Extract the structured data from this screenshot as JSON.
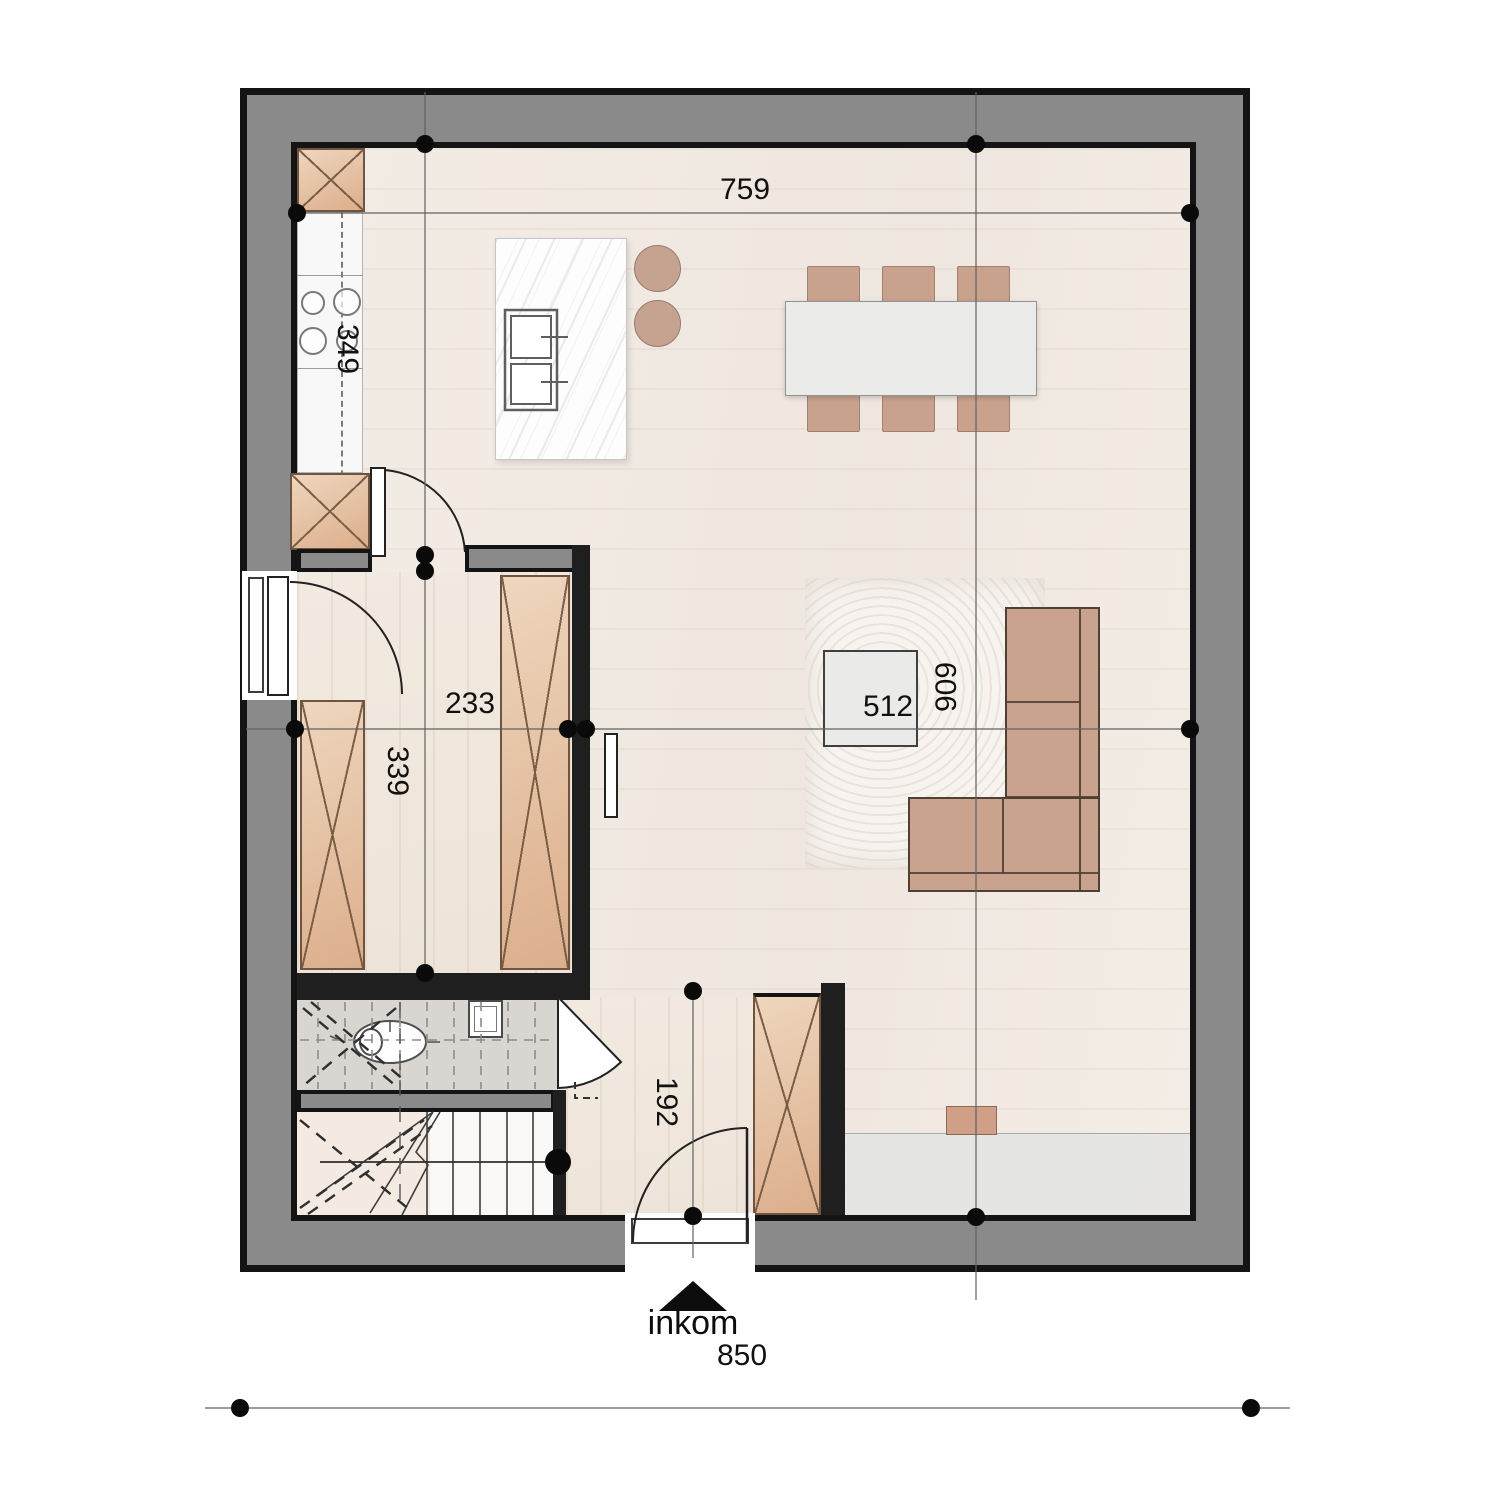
{
  "dimensions": {
    "top_width": "759",
    "kitchen_zone_height": "349",
    "storage_width": "233",
    "storage_height": "339",
    "living_width": "512",
    "interior_height": "909",
    "hall_depth": "192",
    "overall_width": "850"
  },
  "entrance": {
    "label": "inkom"
  },
  "fixtures": [
    "cooktop",
    "double-sink",
    "toilet",
    "washbasin",
    "staircase",
    "walking-line",
    "entrance-arrow",
    "dining-set",
    "l-sofa",
    "coffee-table",
    "kitchen-island",
    "tall-cabinet"
  ],
  "colors": {
    "wall_fill": "#8a8a8a",
    "wall_line": "#141414",
    "floor": "#f2ebe4",
    "wood_cabinet": "#e1bb9d",
    "furniture_tan": "#c9a38e",
    "tile": "#d9d6d2",
    "marble": "#fdfdfd",
    "rug": "#f7f4f0",
    "dim_text": "#111111"
  }
}
